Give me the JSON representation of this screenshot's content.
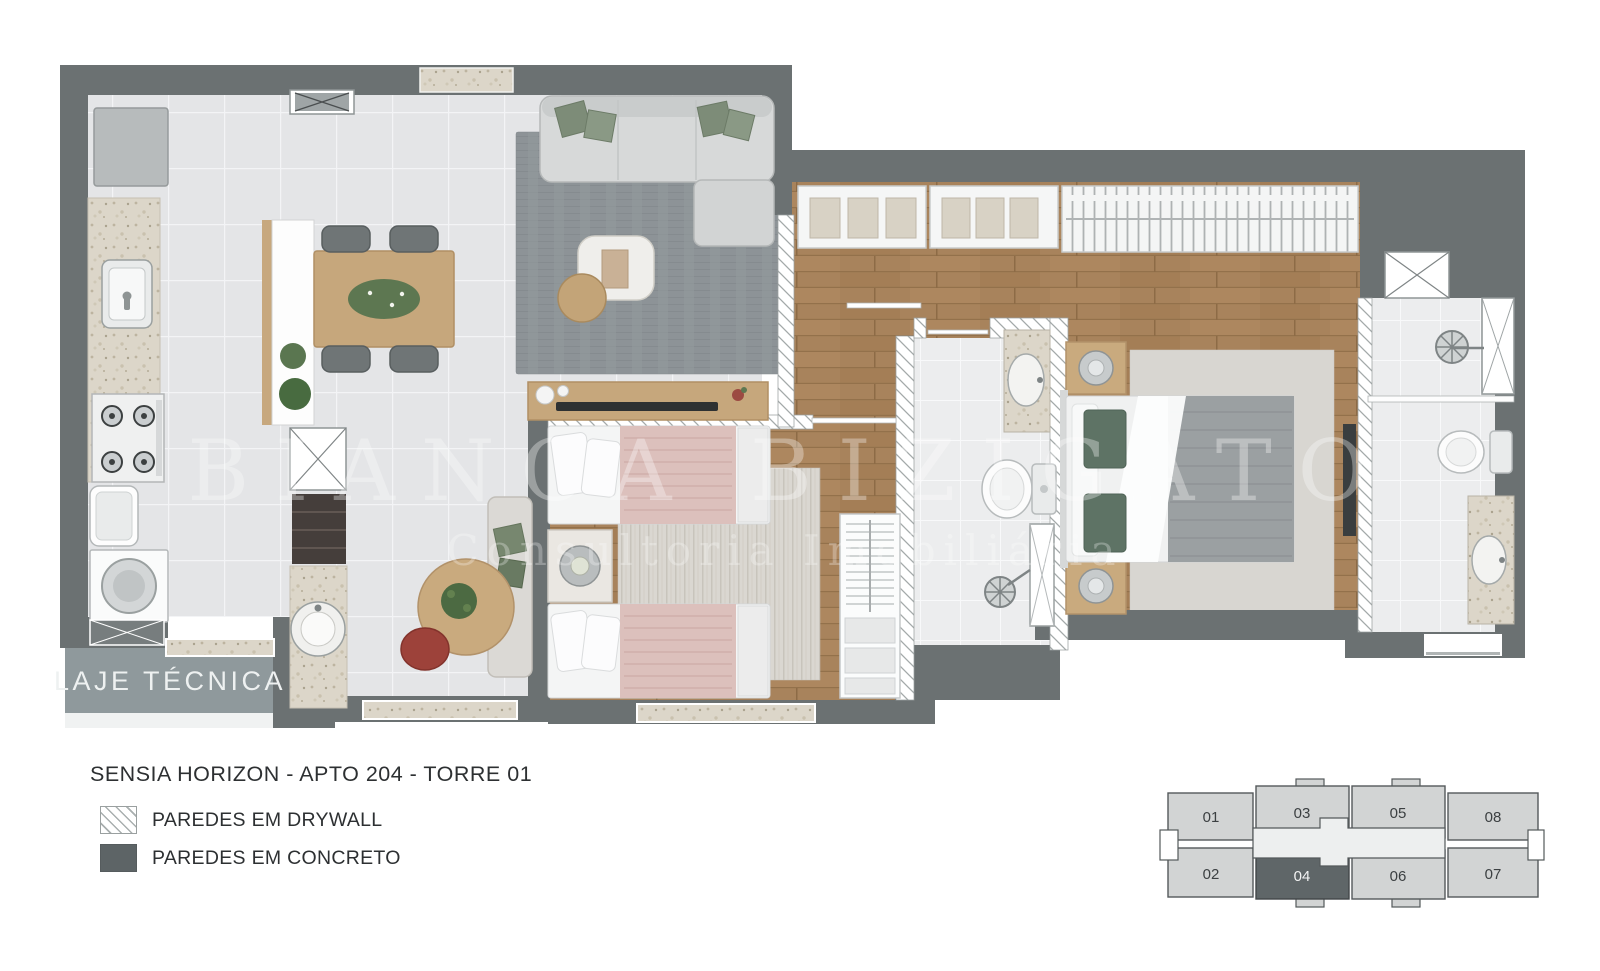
{
  "meta": {
    "title": "SENSIA HORIZON - APTO 204 - TORRE 01"
  },
  "plan": {
    "laje_tecnica_label": "LAJE TÉCNICA",
    "watermark_line1": "BIANCA BIZIGATO",
    "watermark_line2": "Consultoria Imobiliária"
  },
  "legend": {
    "items": [
      {
        "label": "PAREDES EM DRYWALL",
        "swatch": "drywall-hatch"
      },
      {
        "label": "PAREDES EM CONCRETO",
        "swatch": "concrete"
      }
    ]
  },
  "keyplan": {
    "units": [
      {
        "label": "01",
        "highlighted": false
      },
      {
        "label": "02",
        "highlighted": false
      },
      {
        "label": "03",
        "highlighted": false
      },
      {
        "label": "04",
        "highlighted": true
      },
      {
        "label": "05",
        "highlighted": false
      },
      {
        "label": "06",
        "highlighted": false
      },
      {
        "label": "07",
        "highlighted": false
      },
      {
        "label": "08",
        "highlighted": false
      }
    ]
  },
  "colors": {
    "wall_concrete": "#6b7172",
    "drywall_line": "#9aa0a0",
    "tile_floor": "#e4e5e7",
    "wood_floor": "#a8835c",
    "bath_floor": "#ecedee",
    "granite": "#dcd6c9",
    "laje_floor": "#8f999c",
    "keyplan_unit": "#d2d4d4",
    "keyplan_highlight": "#5f6668"
  }
}
